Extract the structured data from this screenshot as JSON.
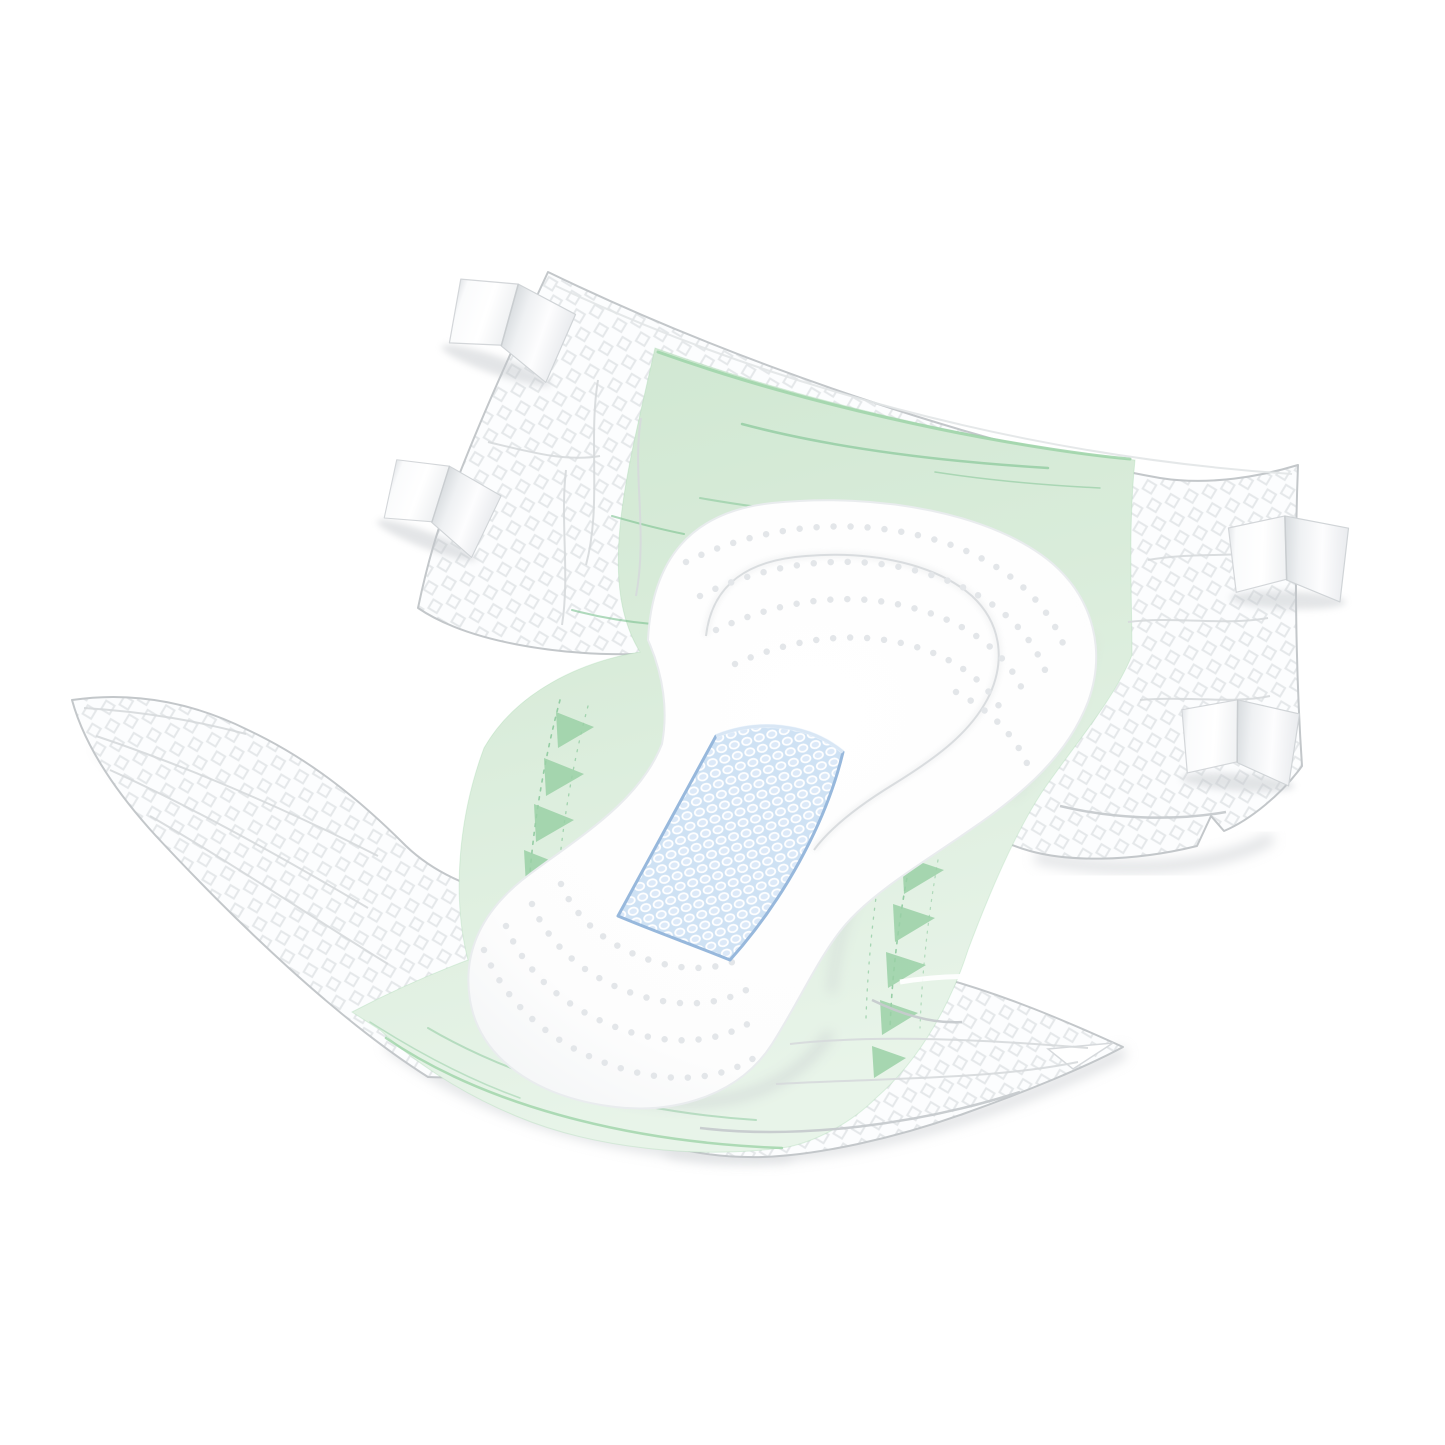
{
  "scene": {
    "type": "product-illustration",
    "alt_text": "Unfolded adult incontinence brief shown diagonally on a white background: green breathable backsheet, white quilted side panels with diamond texture, four white refastenable tape tabs, a white absorbent pad with embossed dot rows, and a blue honeycomb acquisition layer in the center.",
    "background_color": "#ffffff"
  },
  "product": {
    "category": "adult-incontinence-brief",
    "parts": [
      {
        "name": "quilted-side-panels",
        "color": "#fcfdfe",
        "texture": "diamond-lattice",
        "count": 4
      },
      {
        "name": "breathable-backsheet",
        "color": "#d9ecda",
        "texture": "smooth-film-with-sheen-lines"
      },
      {
        "name": "absorbent-pad",
        "color": "#ffffff",
        "texture": "embossed-dot-arcs"
      },
      {
        "name": "acquisition-core",
        "color": "#cfe2f4",
        "texture": "honeycomb-mesh"
      },
      {
        "name": "tape-tabs",
        "color": "#ffffff",
        "count": 4
      },
      {
        "name": "leg-gathers",
        "color": "#9ad0a6",
        "count": 10
      }
    ]
  },
  "palette": {
    "background": "#ffffff",
    "backsheet_green": "#d9ecda",
    "backsheet_green_deep": "#cfe7d1",
    "backsheet_green_light": "#e8f4e9",
    "green_rim": "#9ed3a8",
    "green_streak": "#7cc290",
    "gather_green": "#9ad0a6",
    "wing_white": "#fcfdfe",
    "lattice_gray": "#e5e8ea",
    "edge_gray": "#c3c7ca",
    "crease_gray": "#d6d9dc",
    "crease_dark": "#c6cacd",
    "dot_gray": "#e3e6e9",
    "core_blue": "#cfe2f4",
    "core_border": "#97b8dc",
    "tab_shade": "#dde0e3",
    "shadow_gray": "#c2c6ca"
  }
}
